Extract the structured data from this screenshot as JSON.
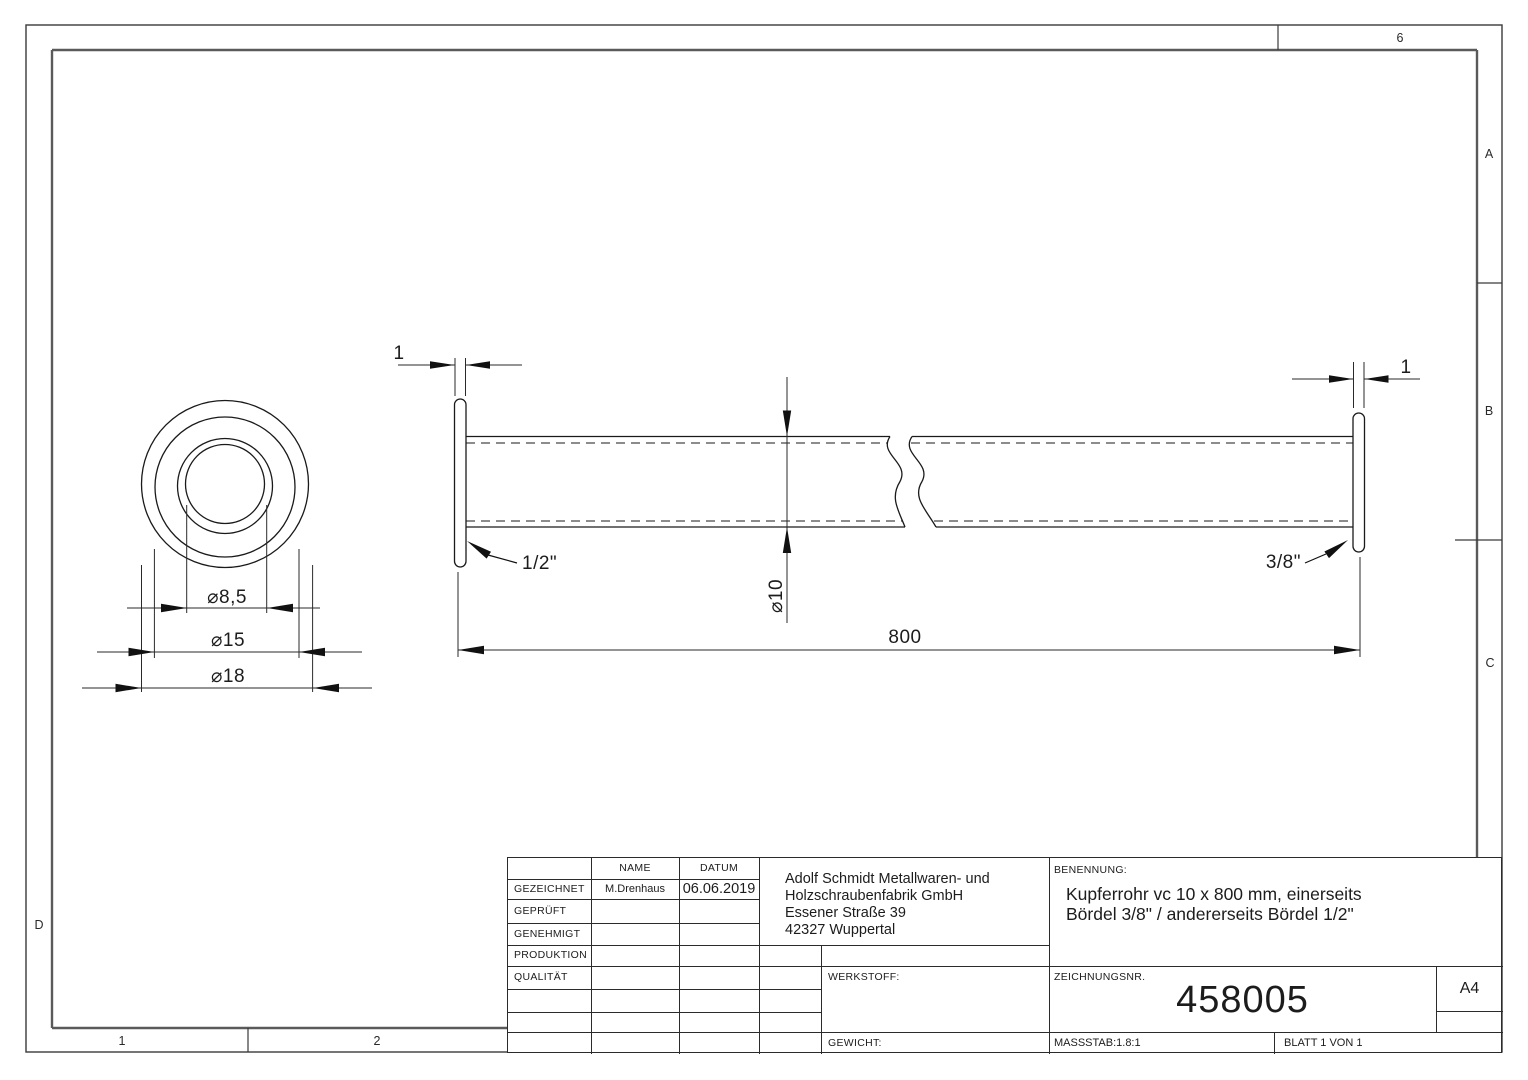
{
  "drawing": {
    "zones": {
      "top": "6",
      "a": "A",
      "b": "B",
      "c": "C",
      "d": "D",
      "one": "1",
      "two": "2"
    },
    "front_view": {
      "d_bore": "⌀8,5",
      "d_mid": "⌀15",
      "d_outer": "⌀18"
    },
    "side_view": {
      "length": "800",
      "diameter": "⌀10",
      "wall_left": "1",
      "wall_right": "1",
      "flare_left": "1/2\"",
      "flare_right": "3/8\""
    }
  },
  "title_block": {
    "header": {
      "name_col": "NAME",
      "datum_col": "DATUM"
    },
    "row_labels": [
      "GEZEICHNET",
      "GEPRÜFT",
      "GENEHMIGT",
      "PRODUKTION",
      "QUALITÄT"
    ],
    "gezeichnet_name": "M.Drenhaus",
    "gezeichnet_datum": "06.06.2019",
    "company_lines": [
      "Adolf Schmidt Metallwaren- und",
      "Holzschraubenfabrik GmbH",
      "Essener Straße 39",
      "42327 Wuppertal"
    ],
    "benennung_label": "BENENNUNG:",
    "benennung_line1": "Kupferrohr vc 10 x  800 mm, einerseits",
    "benennung_line2": "Bördel 3/8\" / andererseits Bördel 1/2\"",
    "werkstoff_label": "WERKSTOFF:",
    "gewicht_label": "GEWICHT:",
    "zeichnungsnr_label": "ZEICHNUNGSNR.",
    "zeichnungsnr": "458005",
    "format": "A4",
    "massstab": "MASSSTAB:1.8:1",
    "blatt": "BLATT 1 VON 1"
  }
}
